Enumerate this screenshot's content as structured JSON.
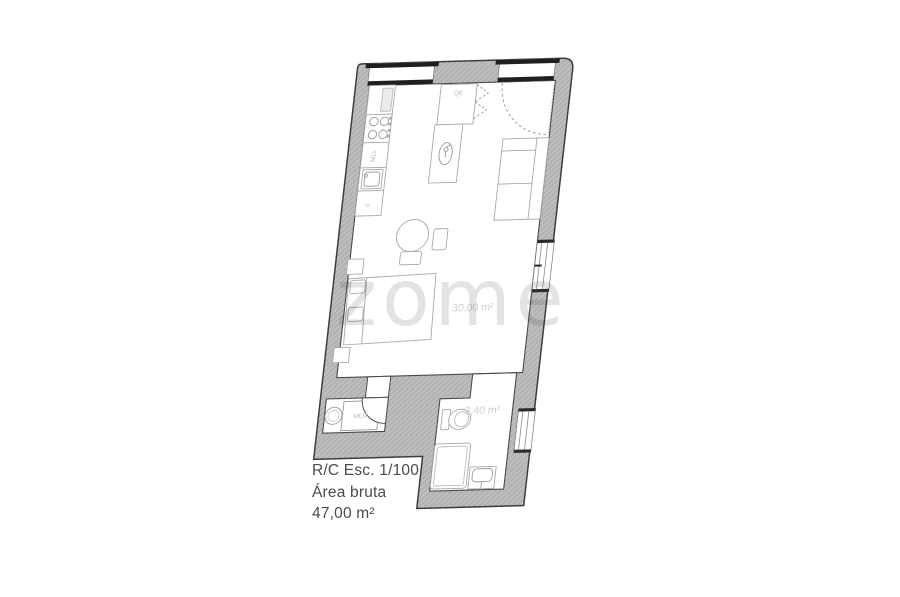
{
  "watermark": {
    "text": "zome"
  },
  "plan": {
    "labels": {
      "qe": "QE",
      "mll": "MLL",
      "fridge": "F",
      "mlr": "MLR",
      "main_area": "30,00 m²",
      "bathroom_area": "3,40 m²"
    }
  },
  "caption": {
    "floor_scale": "R/C Esc. 1/100",
    "area_label": "Área bruta",
    "area_value": "47,00 m²"
  },
  "colors": {
    "wall_fill": "#bdbdbd",
    "wall_hatch": "#a6a6a6",
    "wall_outline": "#3c3c3c",
    "interior_edge": "#4a4a4a",
    "furniture_line": "#a9a9a9",
    "plan_label_text": "#bcbcbc",
    "area_label_text": "#cfcfcf",
    "window_bar": "#1f1f1f",
    "caption_text": "#4b4b4b",
    "watermark_text": "rgba(40,40,40,0.13)"
  }
}
